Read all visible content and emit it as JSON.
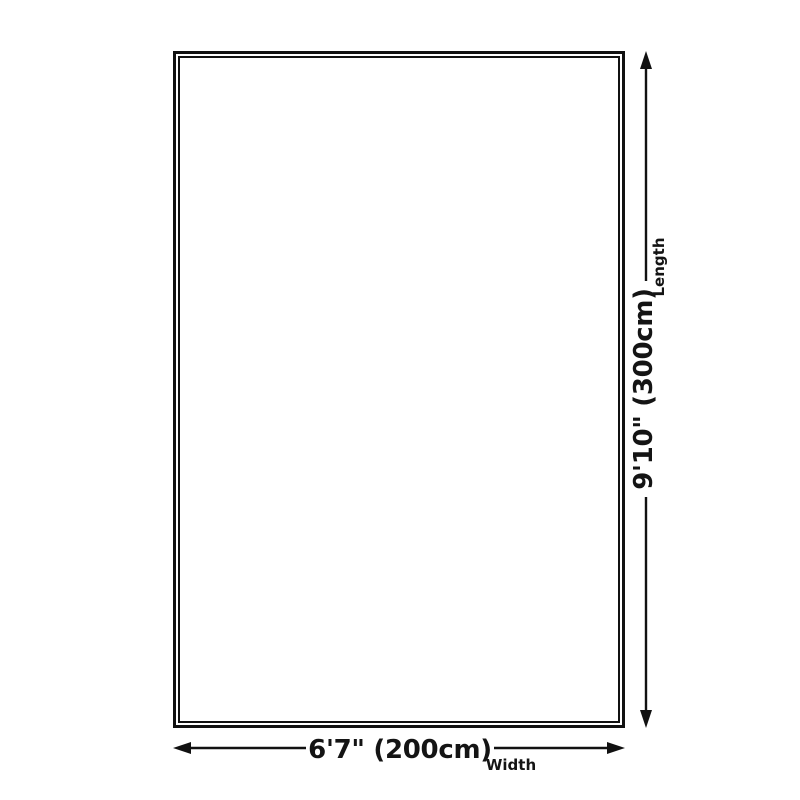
{
  "page": {
    "background_color": "#ffffff"
  },
  "diagram": {
    "shape": "rectangle",
    "outline_color": "#111111",
    "fill_color": "#ffffff",
    "text_color": "#141414",
    "width_dimension": {
      "value": "6'7\" (200cm)",
      "label": "Width"
    },
    "length_dimension": {
      "value": "9'10\" (300cm)",
      "label": "Length"
    }
  }
}
